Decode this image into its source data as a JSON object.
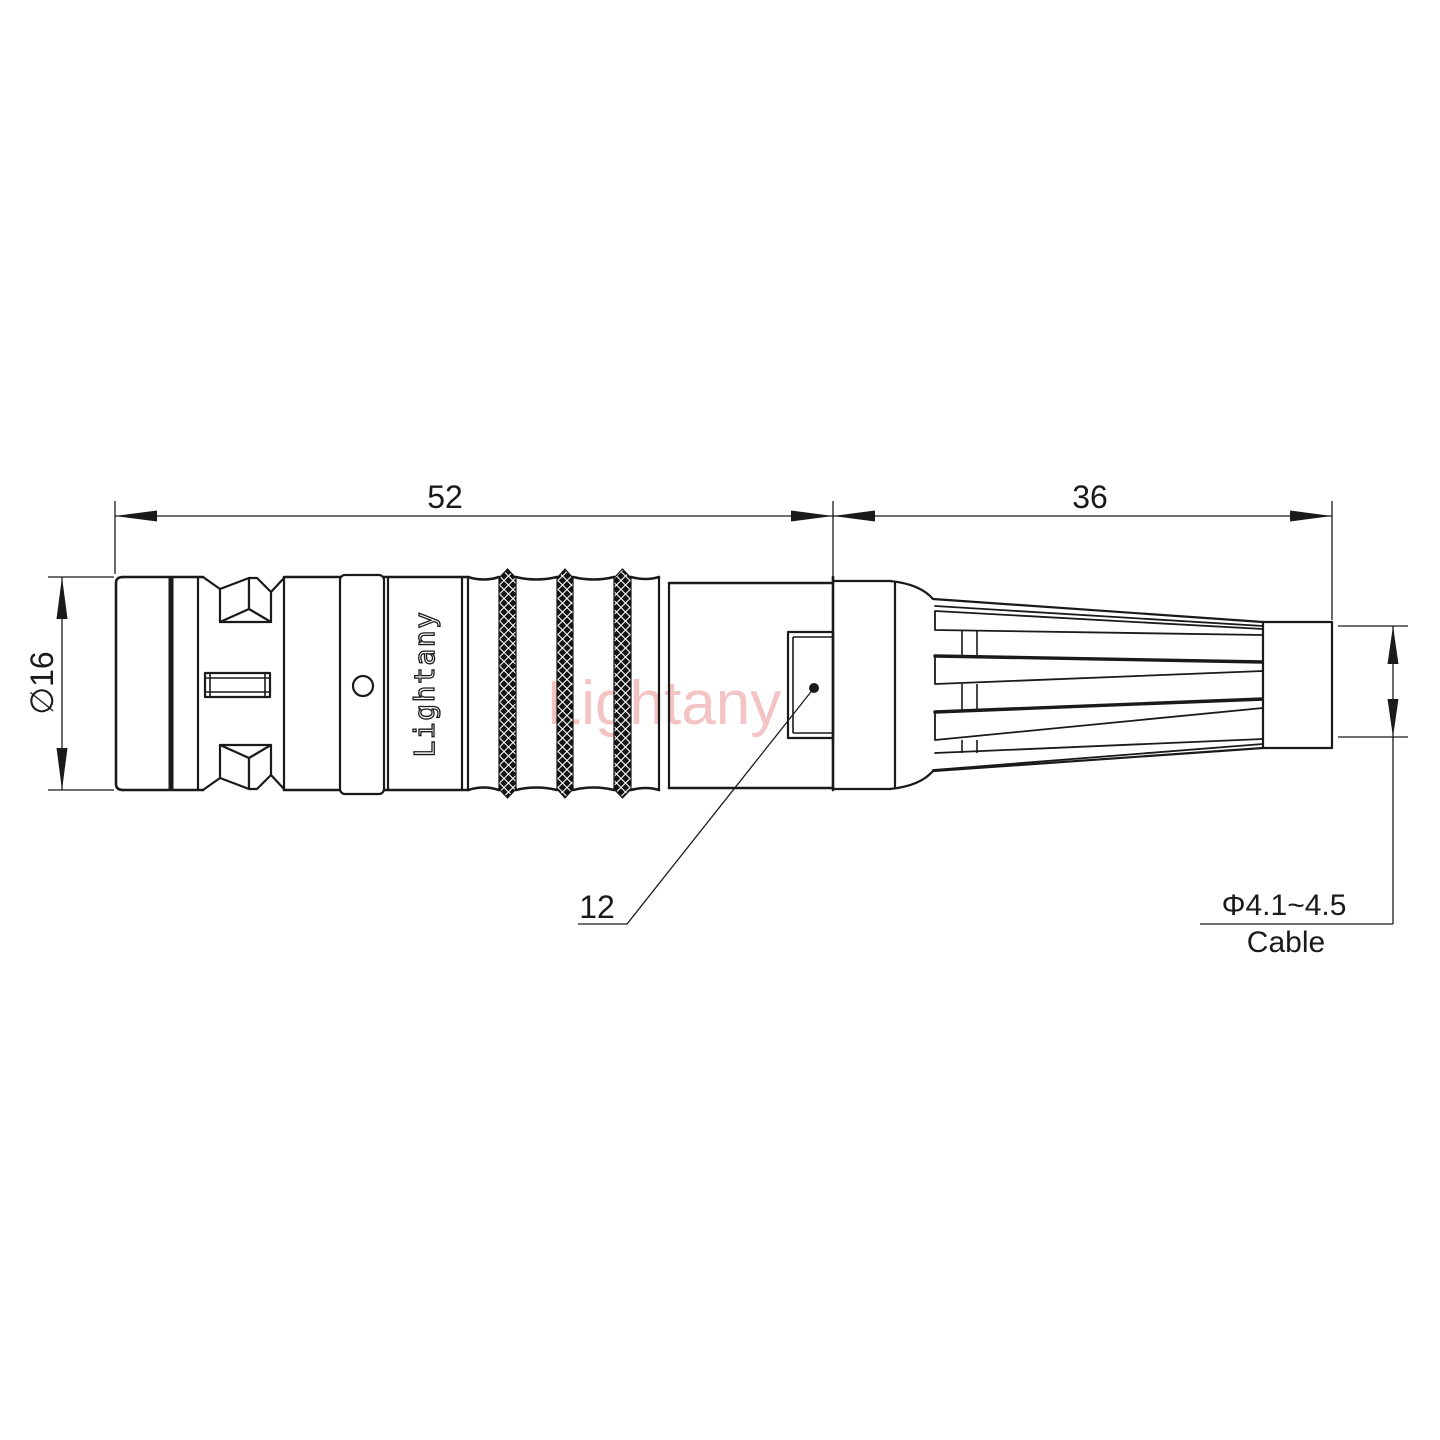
{
  "canvas": {
    "background": "#ffffff",
    "line_color": "#1a1a1a",
    "watermark_color": "#f2b6b6"
  },
  "labels": {
    "dim_body_length": "52",
    "dim_boot_length": "36",
    "dim_shell_diameter": "∅16",
    "dim_latch_window": "12",
    "dim_cable_diameter": "Φ4.1~4.5",
    "dim_cable_caption": "Cable",
    "brand": "Lightany",
    "watermark": "Lightany"
  }
}
